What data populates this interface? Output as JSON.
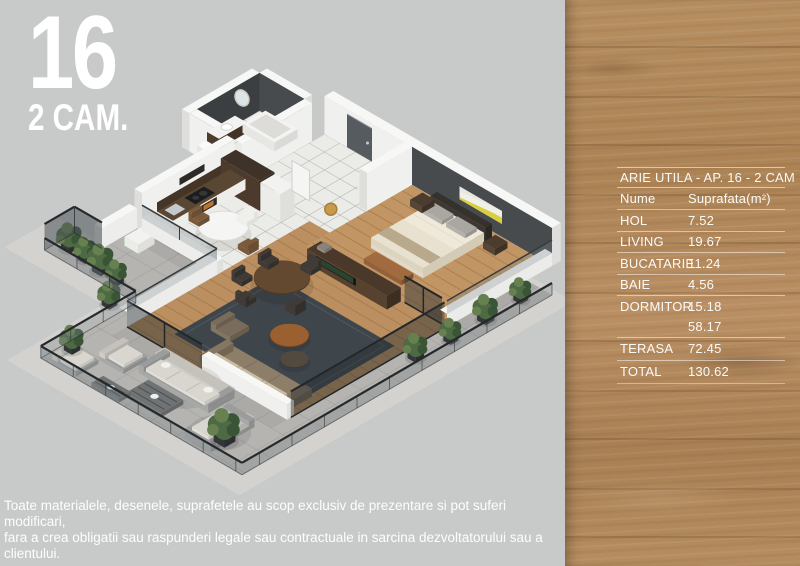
{
  "plan_badge": {
    "number": "16",
    "type": "2 CAM."
  },
  "area_table": {
    "title": "ARIE UTILA - AP. 16 - 2 CAM",
    "header": {
      "name": "Nume",
      "value": "Suprafata(m²)"
    },
    "rows": [
      {
        "label": "HOL",
        "value": "7.52"
      },
      {
        "label": "LIVING",
        "value": "19.67"
      },
      {
        "label": "BUCATARIE",
        "value": "11.24"
      },
      {
        "label": "BAIE",
        "value": "4.56"
      },
      {
        "label": "DORMITOR",
        "value": "15.18"
      },
      {
        "label": "",
        "value": "58.17"
      },
      {
        "label": "TERASA",
        "value": "72.45"
      },
      {
        "label": "TOTAL",
        "value": "130.62"
      }
    ]
  },
  "disclaimer": {
    "line1": "Toate materialele, desenele, suprafetele au scop exclusiv de prezentare si pot suferi modificari,",
    "line2": "fara a crea obligatii sau raspunderi legale sau contractuale in sarcina dezvoltatorului sau a clientului."
  },
  "floorplan": {
    "colors": {
      "background": "#c8cac9",
      "slab": "#d3d2cf",
      "terrace_tile": "#b6b4b1",
      "white_tile": "#ebebe8",
      "wood_floor": "#c29564",
      "wood_floor_living": "#bb8f60",
      "rug": "#3f464b",
      "wall_white": "#f0f0ee",
      "wall_cap": "#f7f7f5",
      "wall_side": "#dededc",
      "wall_charcoal": "#3b3f42",
      "wall_charcoal_light": "#474b4e",
      "walnut": "#4e3b2b",
      "art_yellow": "#d8ce3f",
      "door_gray": "#565b5f",
      "glass": "rgba(120,130,136,0.32)",
      "glass_dark": "rgba(40,46,52,0.45)",
      "rail": "#26292b",
      "plant_green": "#4d6a44",
      "plant_green_dark": "#3a5536",
      "plant_green_light": "#66814f",
      "pot": "#33373a",
      "outdoor_gray": "#8b8d8c",
      "outdoor_cushion": "#d8d6cf",
      "sofa_taupe": "#8d7e6a",
      "sofa_cushion": "#c9bca4",
      "bed_linen": "#efe9da",
      "bench_caramel": "#a16b3f",
      "bronze": "#9a6030"
    }
  }
}
